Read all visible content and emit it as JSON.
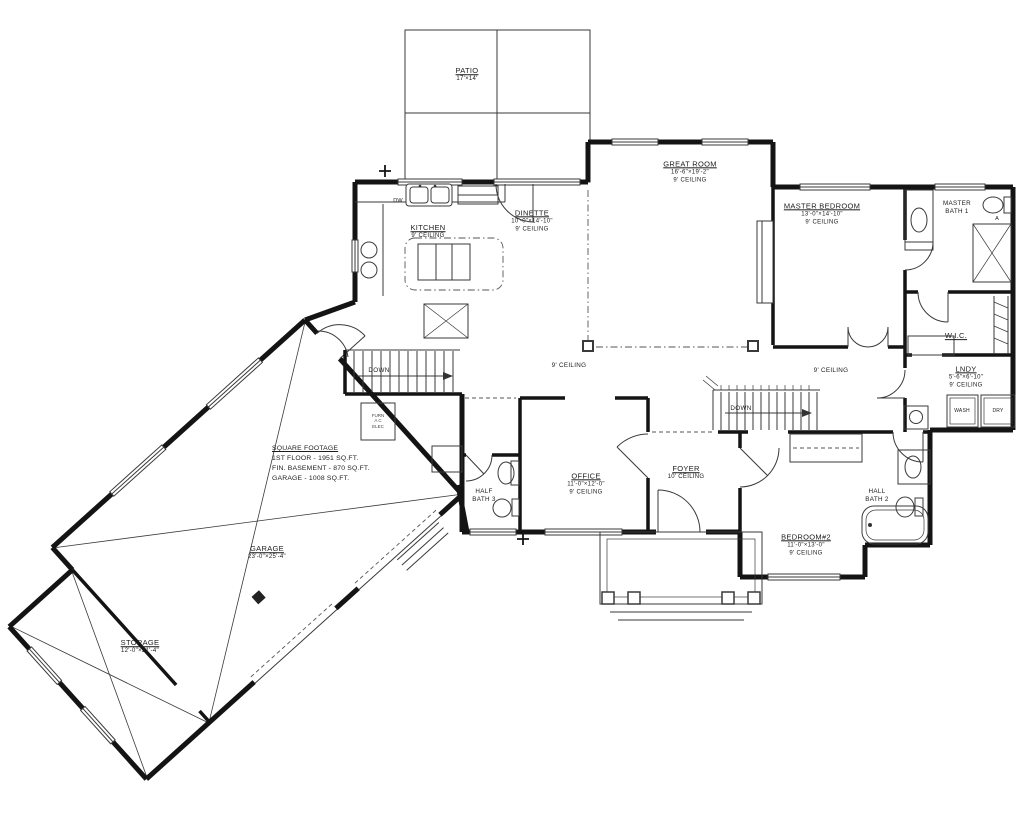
{
  "colors": {
    "wall": "#141414",
    "line": "#3a3a3a",
    "background": "#ffffff"
  },
  "plan": {
    "patio": {
      "name": "PATIO",
      "dims": "17'×14'"
    },
    "great_room": {
      "name": "GREAT ROOM",
      "dims": "16'-6\"×19'-2\"",
      "ceiling": "9' CEILING"
    },
    "master_bedroom": {
      "name": "MASTER BEDROOM",
      "dims": "13'-0\"×14'-10\"",
      "ceiling": "9' CEILING"
    },
    "master_bath": {
      "line1": "MASTER",
      "line2": "BATH 1"
    },
    "kitchen": {
      "name": "KITCHEN",
      "ceiling": "9' CEILING"
    },
    "dinette": {
      "name": "DINETTE",
      "dims": "10'-0\"×14'-10\"",
      "ceiling": "9' CEILING"
    },
    "wic": {
      "name": "W.I.C."
    },
    "lndy": {
      "name": "LNDY",
      "dims": "5'-6\"×6'-10\"",
      "ceiling": "9' CEILING"
    },
    "office": {
      "name": "OFFICE",
      "dims": "11'-0\"×12'-0\"",
      "ceiling": "9' CEILING"
    },
    "foyer": {
      "name": "FOYER",
      "ceiling": "10' CEILING"
    },
    "half_bath": {
      "line1": "HALF",
      "line2": "BATH 3"
    },
    "hall_bath": {
      "line1": "HALL",
      "line2": "BATH 2"
    },
    "bedroom2": {
      "name": "BEDROOM#2",
      "dims": "11'-0\"×13'-0\"",
      "ceiling": "9' CEILING"
    },
    "garage": {
      "name": "GARAGE",
      "dims": "23'-0\"×25'-4\""
    },
    "storage": {
      "name": "STORAGE",
      "dims": "12'-0\"×21'-4\""
    },
    "hall_left_ceiling": "9' CEILING",
    "hall_right_ceiling": "9' CEILING",
    "down_left": "DOWN",
    "down_right": "DOWN",
    "square_footage": {
      "title": "SQUARE FOOTAGE",
      "first_floor": "1ST FLOOR - 1951 SQ.FT.",
      "basement": "FIN. BASEMENT - 870 SQ.FT.",
      "garage": "GARAGE - 1008 SQ.FT."
    },
    "appliances": {
      "dw": "DW",
      "wash": "WASH",
      "dry": "DRY"
    },
    "mech": {
      "l1": "FURN",
      "l2": "A C",
      "l3": "ELEC"
    },
    "door_tag": "A"
  }
}
